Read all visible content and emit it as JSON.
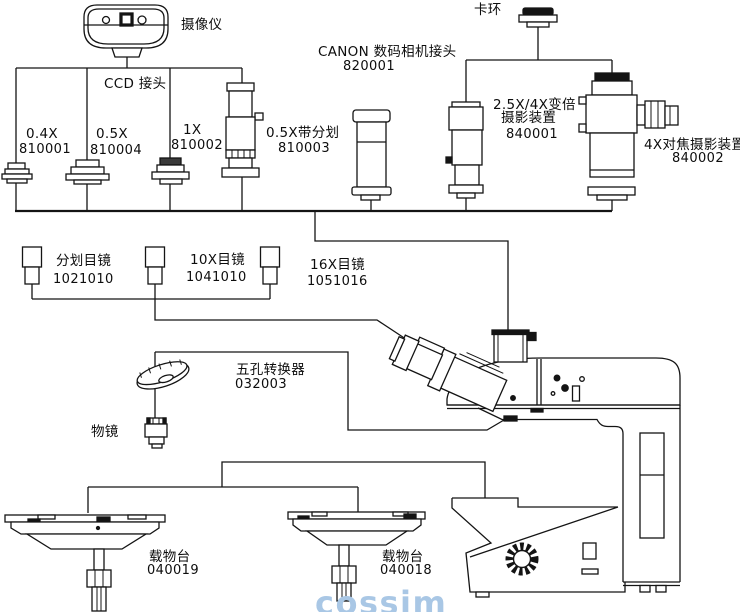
{
  "colors": {
    "line": "#141414",
    "background": "#ffffff",
    "watermark": "#a9c7e5"
  },
  "watermark": {
    "text": "cossim"
  },
  "components": {
    "camera": {
      "label": "摄像仪"
    },
    "ccd_connector": {
      "label": "CCD 接头"
    },
    "adapter_04x": {
      "label": "0.4X",
      "code": "810001"
    },
    "adapter_05x": {
      "label": "0.5X",
      "code": "810004"
    },
    "adapter_1x": {
      "label": "1X",
      "code": "810002"
    },
    "adapter_05x_reticle": {
      "label": "0.5X带分划",
      "code": "810003"
    },
    "canon_adapter": {
      "label": "CANON 数码相机接头",
      "code": "820001"
    },
    "snap_ring": {
      "label": "卡环"
    },
    "zoom_photo_device": {
      "label_line1": "2.5X/4X变倍",
      "label_line2": "摄影装置",
      "code": "840001"
    },
    "focus_photo_device": {
      "label": "4X对焦摄影装置",
      "code": "840002"
    },
    "reticle_eyepiece": {
      "label": "分划目镜",
      "code": "1021010"
    },
    "eyepiece_10x": {
      "label": "10X目镜",
      "code": "1041010"
    },
    "eyepiece_16x": {
      "label": "16X目镜",
      "code": "1051016"
    },
    "nosepiece": {
      "label": "五孔转换器",
      "code": "032003"
    },
    "objective": {
      "label": "物镜"
    },
    "stage_left": {
      "label": "载物台",
      "code": "040019"
    },
    "stage_right": {
      "label": "载物台",
      "code": "040018"
    }
  }
}
